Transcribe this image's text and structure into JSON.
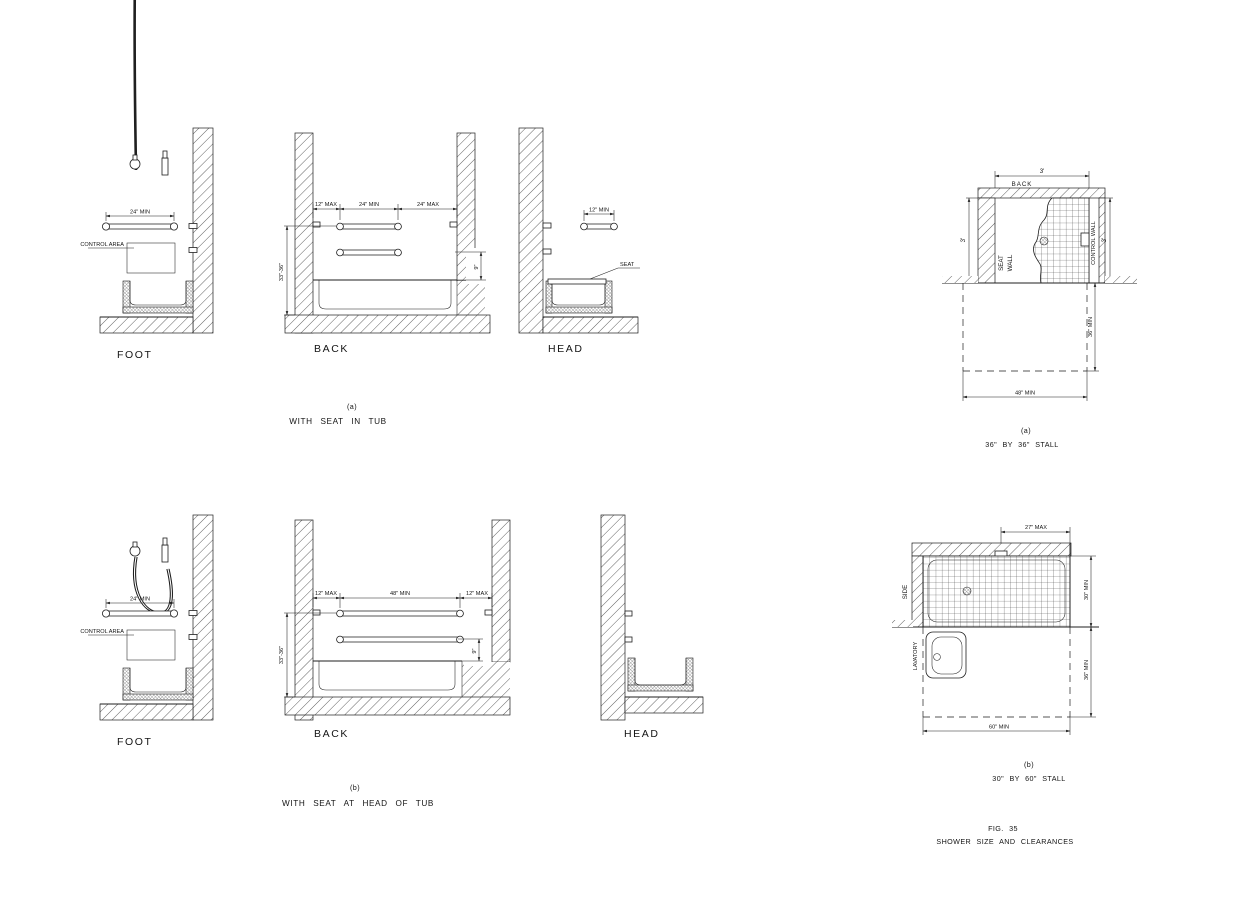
{
  "captions": {
    "fig_line1": "FIG. 35",
    "fig_line2": "SHOWER SIZE AND CLEARANCES"
  },
  "tub_a": {
    "letter": "(a)",
    "title": "WITH SEAT IN TUB",
    "foot_label": "FOOT",
    "back_label": "BACK",
    "head_label": "HEAD",
    "control_area": "CONTROL AREA",
    "foot_bar_dim": "24\" MIN",
    "back_dim_left": "12\" MAX",
    "back_dim_center": "24\" MIN",
    "back_dim_right": "24\" MAX",
    "back_height_dim": "33\"-36\"",
    "back_rim_dim": "9\"",
    "head_bar_dim": "12\" MIN",
    "seat_label": "SEAT"
  },
  "tub_b": {
    "letter": "(b)",
    "title": "WITH SEAT AT HEAD OF TUB",
    "foot_label": "FOOT",
    "back_label": "BACK",
    "head_label": "HEAD",
    "control_area": "CONTROL AREA",
    "foot_bar_dim": "24\" MIN",
    "back_dim_left": "12\" MAX",
    "back_dim_center": "48\" MIN",
    "back_dim_right": "12\" MAX",
    "back_height_dim": "33\"-36\"",
    "back_rim_dim": "9\""
  },
  "stall_a": {
    "letter": "(a)",
    "title": "36\" BY 36\" STALL",
    "back_label": "BACK",
    "seat_wall_line1": "SEAT",
    "seat_wall_line2": "WALL",
    "control_wall_label": "CONTROL WALL",
    "dim_width": "3'",
    "dim_left": "3'",
    "dim_right": "3'",
    "clear_length_dim": "48\" MIN",
    "clear_depth_dim": "36\" MIN"
  },
  "stall_b": {
    "letter": "(b)",
    "title": "30\" BY 60\" STALL",
    "side_label": "SIDE",
    "lavatory_label": "LAVATORY",
    "dim_top": "27\" MAX",
    "stall_depth_dim": "30\" MIN",
    "clear_depth_dim": "36\" MIN",
    "clear_length_dim": "60\" MIN"
  },
  "colors": {
    "line": "#1f1f1f",
    "background": "#ffffff"
  }
}
